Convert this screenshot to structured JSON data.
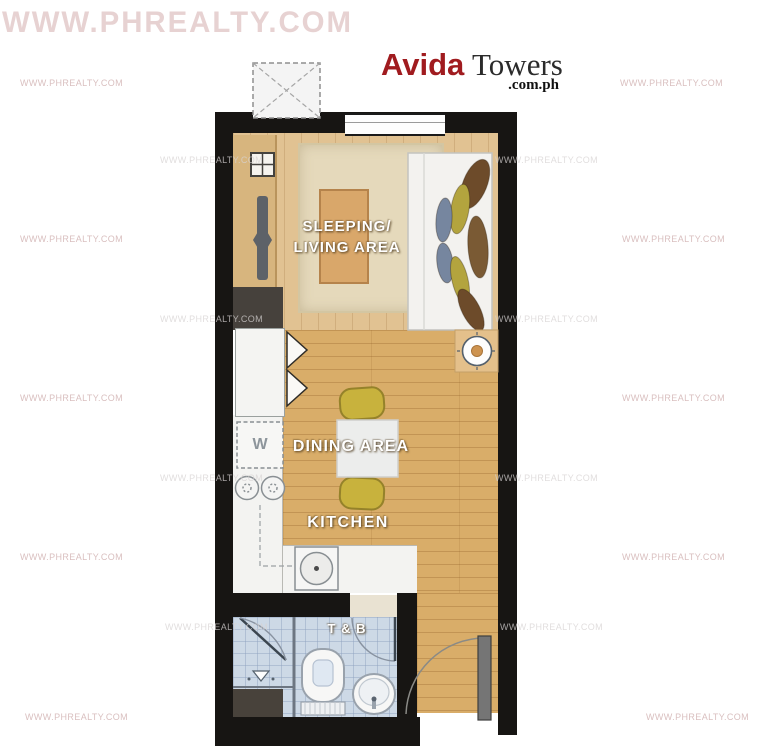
{
  "brand": {
    "name": "Avida",
    "suffix": "Towers",
    "domain": ".com.ph"
  },
  "watermark": {
    "large": "WWW.PHREALTY.COM",
    "small": "WWW.PHREALTY.COM"
  },
  "rooms": {
    "sleeping_line1": "SLEEPING/",
    "sleeping_line2": "LIVING AREA",
    "dining": "DINING AREA",
    "kitchen": "KITCHEN",
    "bath": "T & B"
  },
  "appliances": {
    "washer": "W"
  },
  "colors": {
    "wall": "#171513",
    "brand_red": "#a01b1f",
    "wood_living": "#e1c292",
    "wood_dining": "#d9ad69",
    "rug": "#e5d9bb",
    "coffee_table": "#d9a76a",
    "chair_yellow": "#c8b23d",
    "bath_tile": "#cdd9e6",
    "pillow_brown": "#6d4b2a",
    "pillow_olive": "#b3a43e",
    "pillow_blue": "#76869f",
    "watermark_pink": "#d9bfbf"
  }
}
